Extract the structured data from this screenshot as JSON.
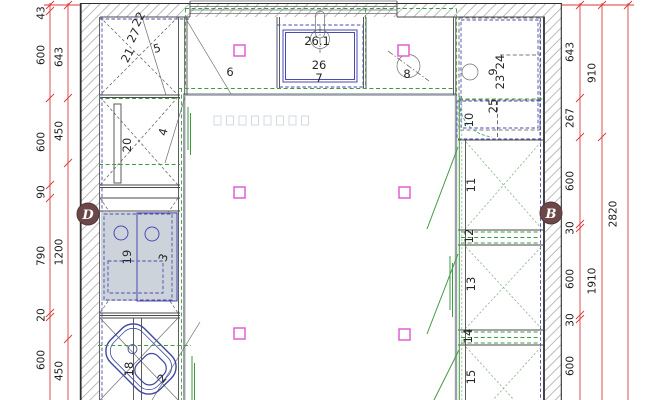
{
  "markers": {
    "left": "D",
    "right": "B"
  },
  "item_labels": {
    "2": "2",
    "3": "3",
    "4": "4",
    "5": "5",
    "6": "6",
    "7": "7",
    "8": "8",
    "9": "9",
    "10": "10",
    "11": "11",
    "12": "12",
    "13": "13",
    "14": "14",
    "15": "15",
    "18": "18",
    "19": "19",
    "20": "20",
    "21": "21",
    "22": "22",
    "23": "23",
    "24": "24",
    "25": "25",
    "26": "26",
    "26_1": "26.1",
    "27": "27"
  },
  "dimensions": {
    "left_inner": [
      "43",
      "600",
      "600",
      "90",
      "790",
      "20",
      "600"
    ],
    "left_outer": [
      "643",
      "450",
      "1200",
      "450"
    ],
    "right_inner": [
      "643",
      "267",
      "600",
      "30",
      "600",
      "30",
      "600"
    ],
    "right_middle": [
      "910",
      "1910"
    ],
    "right_outer": [
      "2820"
    ]
  },
  "colors": {
    "red": "#d93a3a",
    "green": "#3f9b3f",
    "green_soft": "#8cb48c",
    "blue": "#4a4ab2",
    "navy": "#3f46a3",
    "magenta": "#e05fd5",
    "counter": "#9aa0a8",
    "teal": "#3aa6a6",
    "faint": "#c9cfda",
    "marker_bg": "#6b4748",
    "wall": "#303030",
    "hatch": "#bcbcbc",
    "appliance_fill": "#cdd3da"
  }
}
